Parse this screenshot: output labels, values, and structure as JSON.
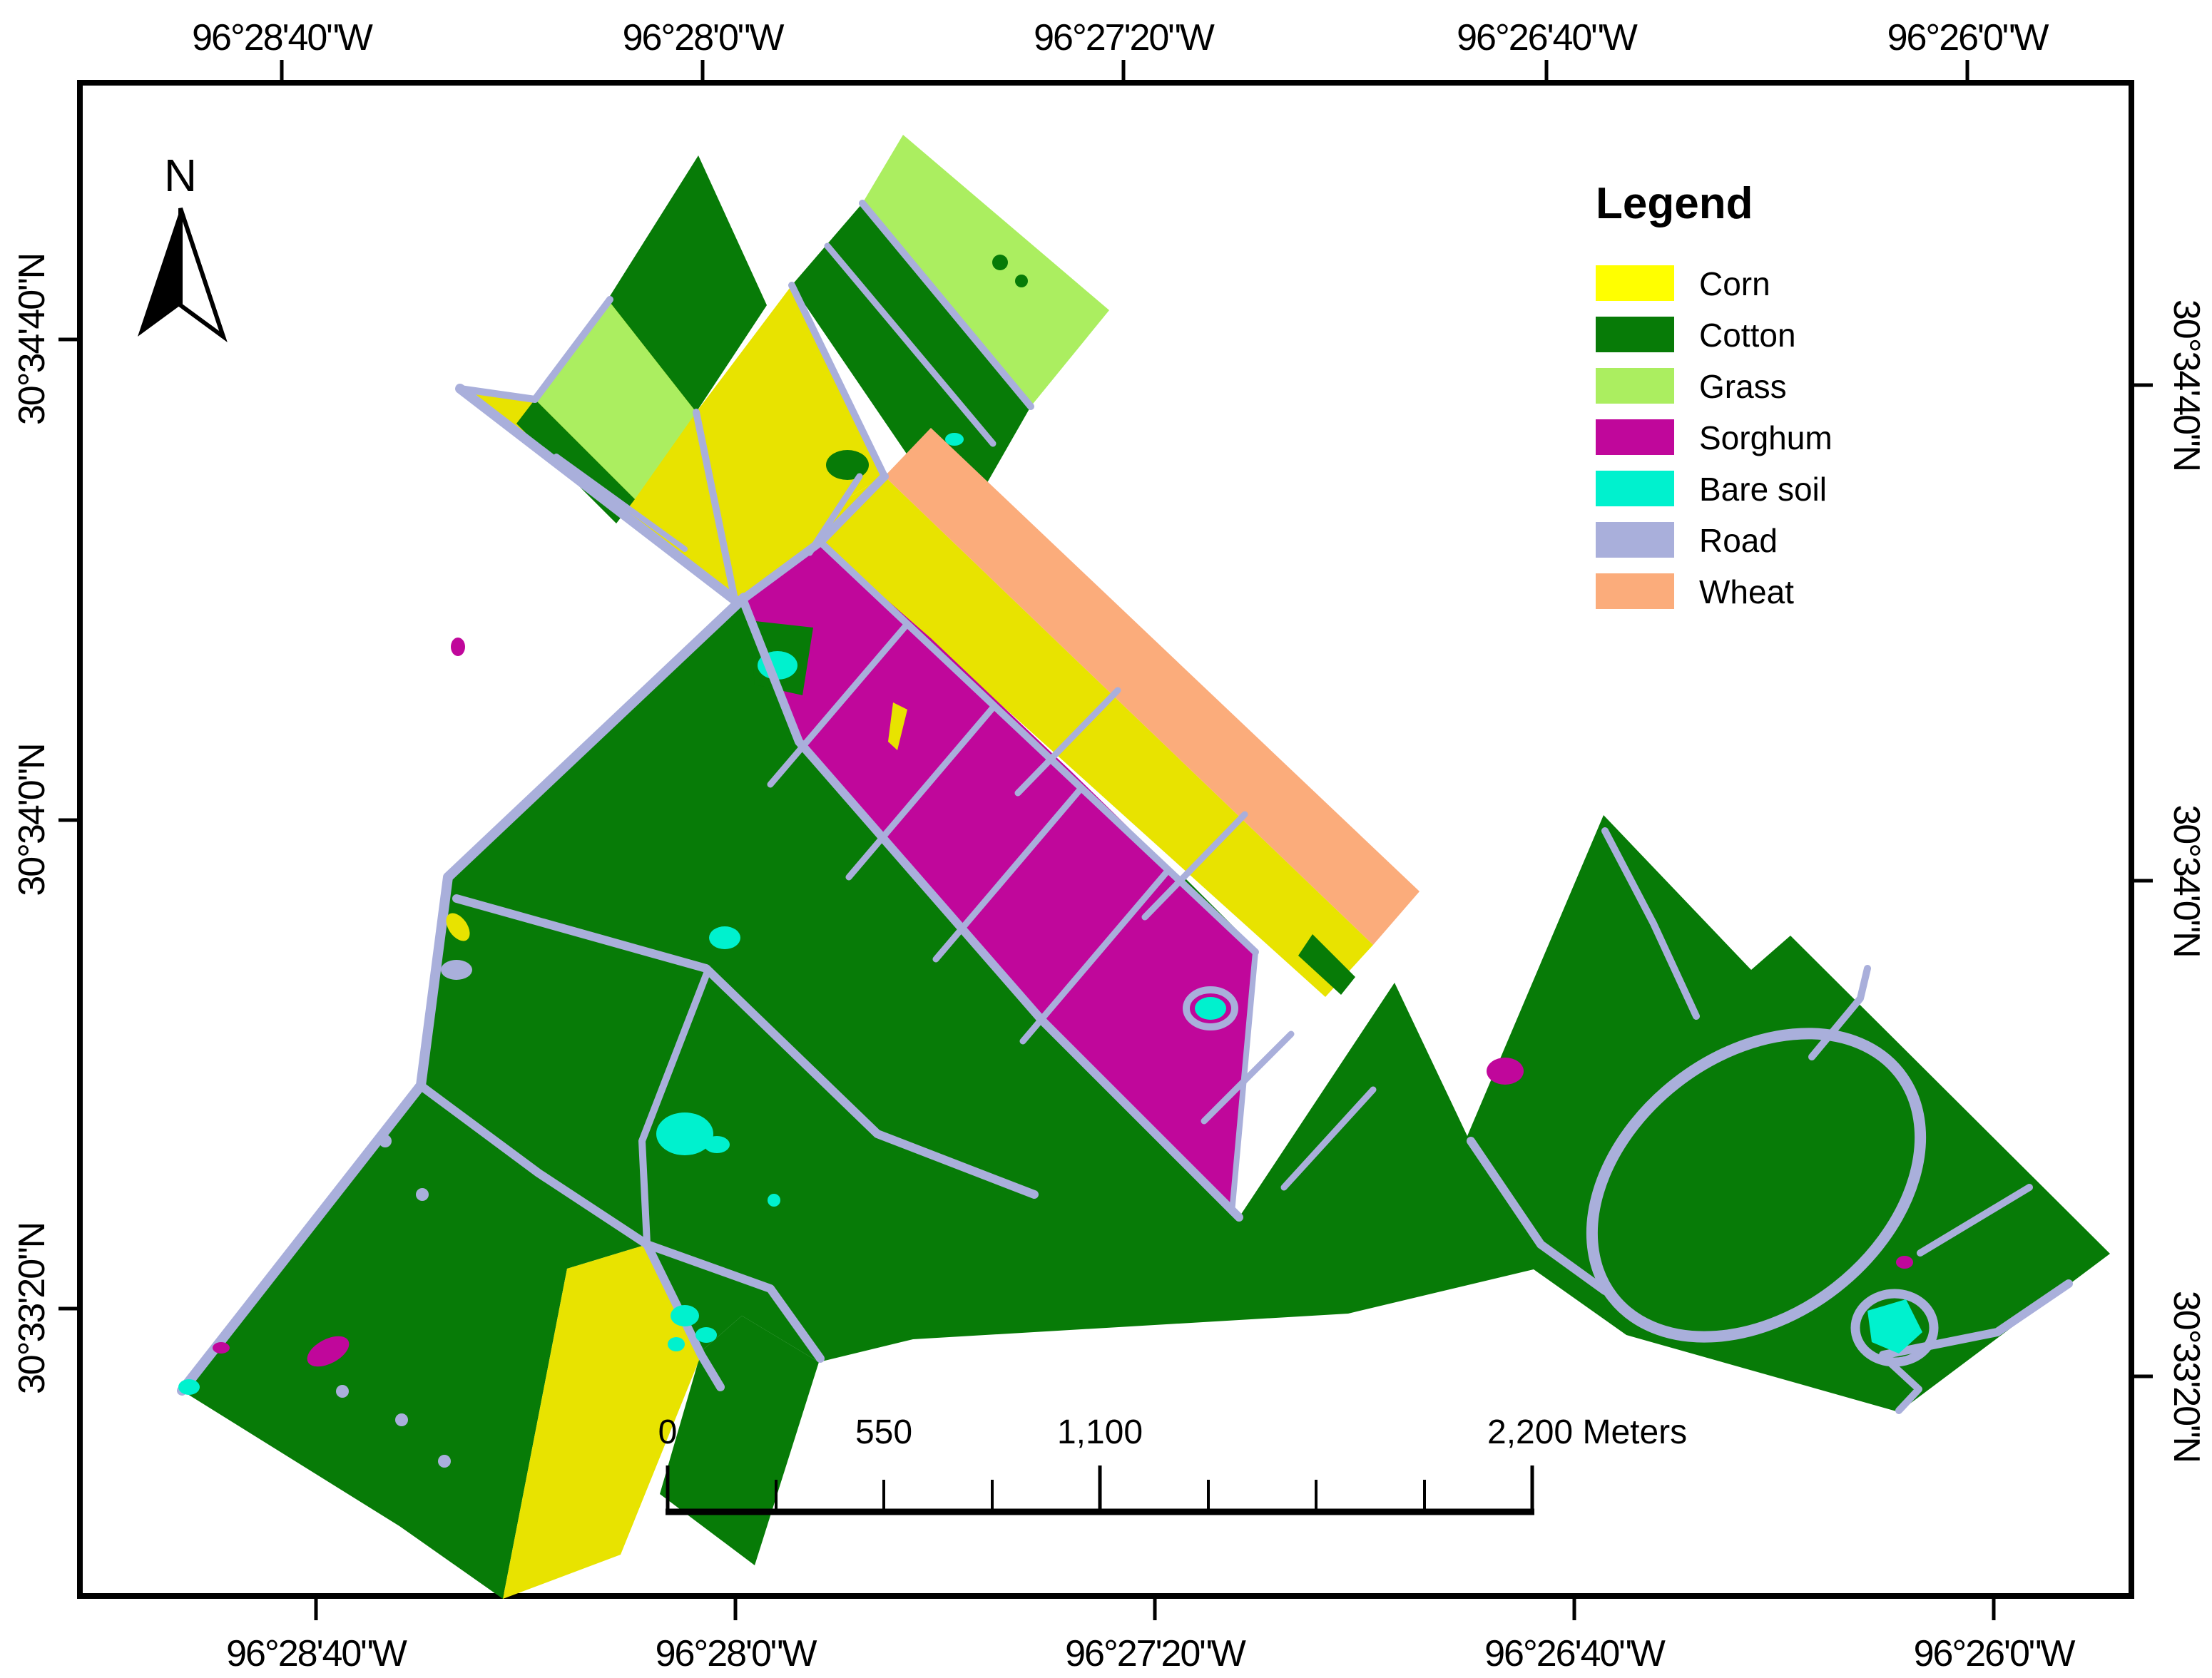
{
  "figure": {
    "kind": "land-cover-classification-map",
    "north_label": "N"
  },
  "colors": {
    "corn": "#FFFF00",
    "corn_map": "#E8E300",
    "cotton": "#077B07",
    "grass": "#ABEE60",
    "sorghum": "#C0079B",
    "bare_soil": "#00F1CE",
    "road": "#A9AFDB",
    "wheat": "#FBAC7B",
    "frame": "#000000",
    "background": "#FFFFFF"
  },
  "legend": {
    "title": "Legend",
    "items": [
      {
        "label": "Corn",
        "class_key": "corn"
      },
      {
        "label": "Cotton",
        "class_key": "cotton"
      },
      {
        "label": "Grass",
        "class_key": "grass"
      },
      {
        "label": "Sorghum",
        "class_key": "sorghum"
      },
      {
        "label": "Bare soil",
        "class_key": "bare_soil"
      },
      {
        "label": "Road",
        "class_key": "road"
      },
      {
        "label": "Wheat",
        "class_key": "wheat"
      }
    ]
  },
  "scale_bar": {
    "tick_labels": [
      "0",
      "550",
      "1,100"
    ],
    "end_label": "2,200 Meters"
  },
  "axes": {
    "top_labels": [
      "96°28'40\"W",
      "96°28'0\"W",
      "96°27'20\"W",
      "96°26'40\"W",
      "96°26'0\"W"
    ],
    "bottom_labels": [
      "96°28'40\"W",
      "96°28'0\"W",
      "96°27'20\"W",
      "96°26'40\"W",
      "96°26'0\"W"
    ],
    "left_labels": [
      "30°34'40\"N",
      "30°34'0\"N",
      "30°33'20\"N"
    ],
    "right_labels": [
      "30°34'40\"N",
      "30°34'0\"N",
      "30°33'20\"N"
    ]
  }
}
